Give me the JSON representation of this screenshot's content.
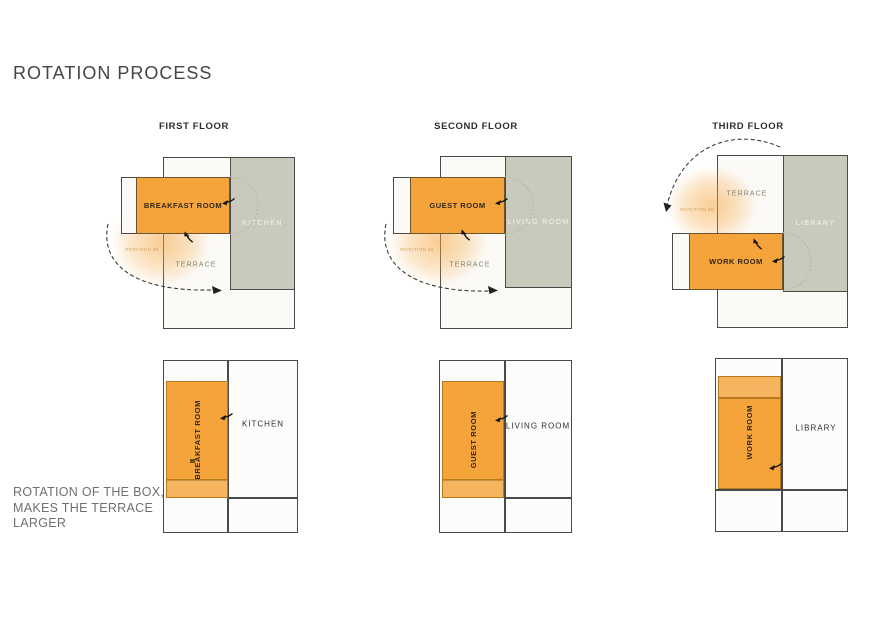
{
  "title": "ROTATION PROCESS",
  "caption": "ROTATION OF THE BOX,\nMAKES THE TERRACE\nLARGER",
  "colors": {
    "room_orange": "#F5A43C",
    "room_orange_border": "#B8791D",
    "fixed_room_gray": "#C9CABC",
    "outline_dark": "#4A4A4A",
    "glow_orange": "rgba(245,164,60,0.55)",
    "label_white": "#F4F4EE",
    "text_gray": "#707070"
  },
  "floors": [
    {
      "header": "FIRST FLOOR",
      "top": {
        "room": "BREAKFAST ROOM",
        "fixed": "KITCHEN",
        "terrace": "TERRACE",
        "rotation_note": "ROTATION 90"
      },
      "bottom": {
        "room": "BREAKFAST ROOM",
        "fixed": "KITCHEN"
      }
    },
    {
      "header": "SECOND FLOOR",
      "top": {
        "room": "GUEST ROOM",
        "fixed": "LIVING ROOM",
        "terrace": "TERRACE",
        "rotation_note": "ROTATION 90"
      },
      "bottom": {
        "room": "GUEST ROOM",
        "fixed": "LIVING ROOM"
      }
    },
    {
      "header": "THIRD FLOOR",
      "top": {
        "room": "WORK ROOM",
        "fixed": "LIBRARY",
        "terrace": "TERRACE",
        "rotation_note": "ROTATION 90"
      },
      "bottom": {
        "room": "WORK ROOM",
        "fixed": "LIBRARY"
      }
    }
  ]
}
